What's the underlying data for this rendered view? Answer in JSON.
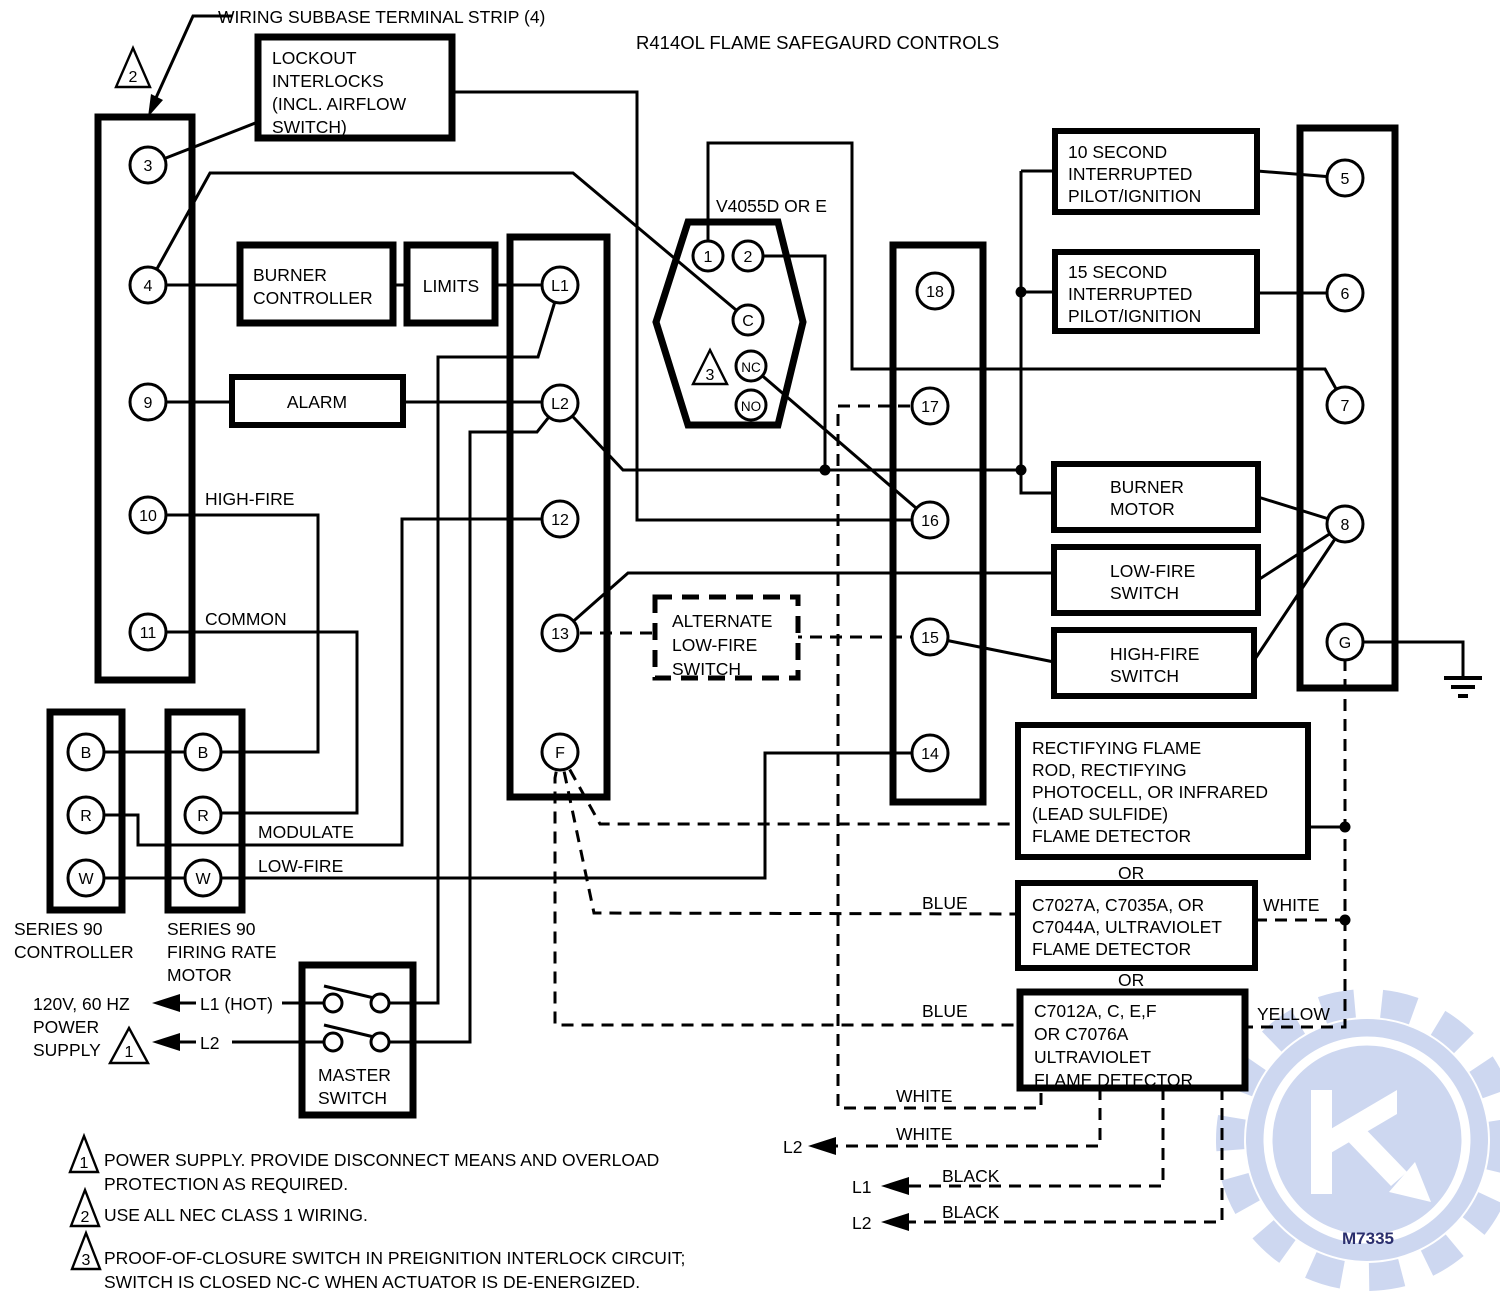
{
  "title": "R414OL FLAME SAFEGAURD CONTROLS",
  "subbase_label": "WIRING SUBBASE TERMINAL STRIP (4)",
  "callouts": {
    "wiring_class": "2"
  },
  "strips": {
    "left": {
      "terminals": [
        "3",
        "4",
        "9",
        "10",
        "11"
      ]
    },
    "middle": {
      "terminals": [
        "L1",
        "L2",
        "12",
        "13",
        "F"
      ]
    },
    "mid_right": {
      "terminals": [
        "18",
        "17",
        "16",
        "15",
        "14"
      ]
    },
    "right": {
      "terminals": [
        "5",
        "6",
        "7",
        "8",
        "G"
      ]
    }
  },
  "valve": {
    "label": "V4055D OR E",
    "terminals": [
      "1",
      "2",
      "C",
      "NC",
      "NO"
    ],
    "callout": "3"
  },
  "components": {
    "lockout": {
      "lines": [
        "LOCKOUT",
        "INTERLOCKS",
        "(INCL. AIRFLOW",
        "SWITCH)"
      ]
    },
    "burner_controller": {
      "lines": [
        "BURNER",
        "CONTROLLER"
      ]
    },
    "limits": {
      "label": "LIMITS"
    },
    "alarm": {
      "label": "ALARM"
    },
    "pilot10": {
      "lines": [
        "10 SECOND",
        "INTERRUPTED",
        "PILOT/IGNITION"
      ]
    },
    "pilot15": {
      "lines": [
        "15 SECOND",
        "INTERRUPTED",
        "PILOT/IGNITION"
      ]
    },
    "burner_motor": {
      "lines": [
        "BURNER",
        "MOTOR"
      ]
    },
    "low_fire_switch": {
      "lines": [
        "LOW-FIRE",
        "SWITCH"
      ]
    },
    "high_fire_switch": {
      "lines": [
        "HIGH-FIRE",
        "SWITCH"
      ]
    },
    "alt_low_fire": {
      "lines": [
        "ALTERNATE",
        "LOW-FIRE",
        "SWITCH"
      ]
    },
    "rectifying": {
      "lines": [
        "RECTIFYING FLAME",
        "ROD, RECTIFYING",
        "PHOTOCELL, OR INFRARED",
        "(LEAD SULFIDE)",
        "FLAME DETECTOR"
      ]
    },
    "c7027": {
      "lines": [
        "C7027A, C7035A, OR",
        "C7044A, ULTRAVIOLET",
        "FLAME DETECTOR"
      ]
    },
    "c7012": {
      "lines": [
        "C7012A, C, E,F",
        "OR C7076A",
        "ULTRAVIOLET",
        "FLAME DETECTOR"
      ]
    }
  },
  "or_separator": "OR",
  "series90": {
    "controller": {
      "label_lines": [
        "SERIES 90",
        "CONTROLLER"
      ],
      "terminals": [
        "B",
        "R",
        "W"
      ]
    },
    "firing_rate_motor": {
      "label_lines": [
        "SERIES 90",
        "FIRING RATE",
        "MOTOR"
      ],
      "terminals": [
        "B",
        "R",
        "W"
      ]
    }
  },
  "master_switch": {
    "lines": [
      "MASTER",
      "SWITCH"
    ]
  },
  "power_supply": {
    "lines": [
      "120V, 60 HZ",
      "POWER",
      "SUPPLY"
    ],
    "callout": "1",
    "l1": "L1 (HOT)",
    "l2": "L2"
  },
  "wire_labels": {
    "high_fire": "HIGH-FIRE",
    "common": "COMMON",
    "modulate": "MODULATE",
    "low_fire": "LOW-FIRE",
    "blue_upper": "BLUE",
    "blue_lower": "BLUE",
    "white_right": "WHITE",
    "yellow": "YELLOW",
    "white_17": "WHITE",
    "white_l2": "WHITE",
    "black_l1": "BLACK",
    "black_l2": "BLACK",
    "arrow_l2_white": "L2",
    "arrow_l1_black": "L1",
    "arrow_l2_black": "L2"
  },
  "notes": [
    {
      "num": "1",
      "lines": [
        "POWER SUPPLY. PROVIDE DISCONNECT MEANS AND OVERLOAD",
        "PROTECTION AS REQUIRED."
      ]
    },
    {
      "num": "2",
      "lines": [
        "USE ALL NEC CLASS 1 WIRING."
      ]
    },
    {
      "num": "3",
      "lines": [
        "PROOF-OF-CLOSURE SWITCH IN PREIGNITION INTERLOCK CIRCUIT;",
        "SWITCH IS CLOSED NC-C WHEN ACTUATOR IS DE-ENERGIZED."
      ]
    }
  ],
  "doc_number": "M7335"
}
